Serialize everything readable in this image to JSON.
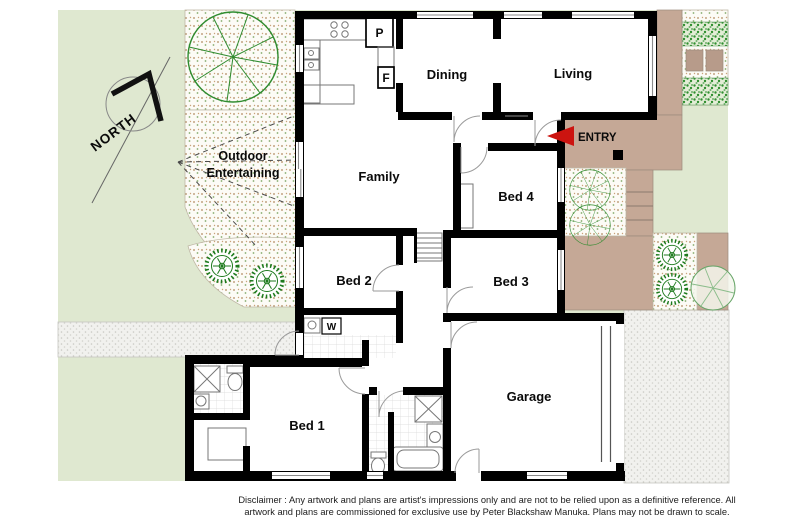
{
  "rooms": {
    "dining": "Dining",
    "living": "Living",
    "family": "Family",
    "bed1": "Bed 1",
    "bed2": "Bed 2",
    "bed3": "Bed 3",
    "bed4": "Bed 4",
    "garage": "Garage"
  },
  "outdoor": {
    "line1": "Outdoor",
    "line2": "Entertaining"
  },
  "compass": {
    "label": "NORTH"
  },
  "entry": {
    "label": "ENTRY"
  },
  "fixtures": {
    "pantry": "P",
    "fridge": "F",
    "washer": "W"
  },
  "disclaimer": {
    "line1": "Disclaimer : Any artwork and plans are artist's impressions only and are not to be relied upon as a definitive reference. All",
    "line2": "artwork and plans are commissioned for exclusive use by Peter Blackshaw Manuka. Plans may not be drawn to scale."
  },
  "colors": {
    "lawn": "#dfe8d0",
    "deck": "#c5a896",
    "deck_dark": "#b79b8a",
    "entry_arrow": "#cc1410",
    "wall": "#000000",
    "tree": "#2e8b2e",
    "shrub": "#1d7a1d",
    "path_grey": "#f1f1ee",
    "bed_cream": "#fcfbf6"
  }
}
